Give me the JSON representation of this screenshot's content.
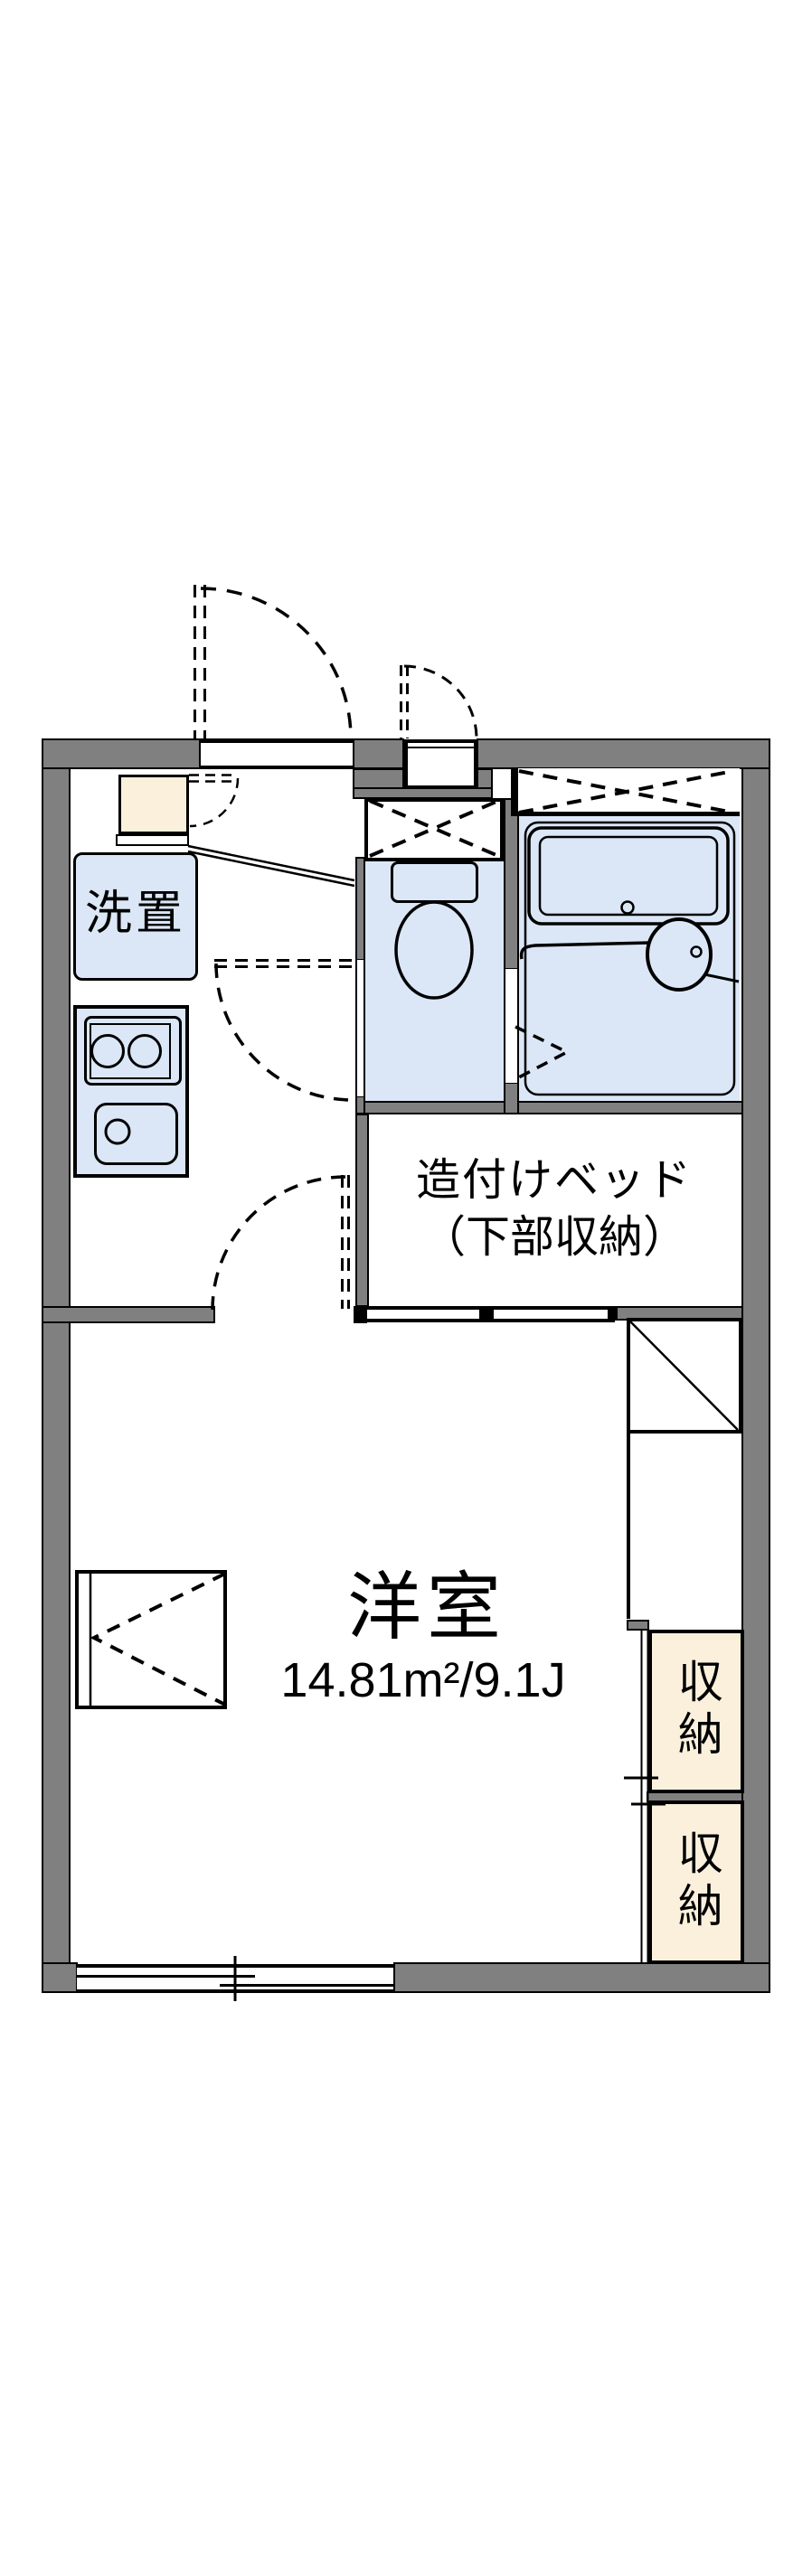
{
  "colors": {
    "wall": "#808080",
    "wet": "#dbe7f7",
    "cream": "#faf0dc",
    "line": "#000000",
    "paper": "#ffffff"
  },
  "labels": {
    "laundry": "洗置",
    "bed_line1": "造付けベッド",
    "bed_line2": "（下部収納）",
    "room": "洋室",
    "room_area": "14.81m²/9.1J",
    "storage_upper": "収納",
    "storage_lower": "収納"
  }
}
